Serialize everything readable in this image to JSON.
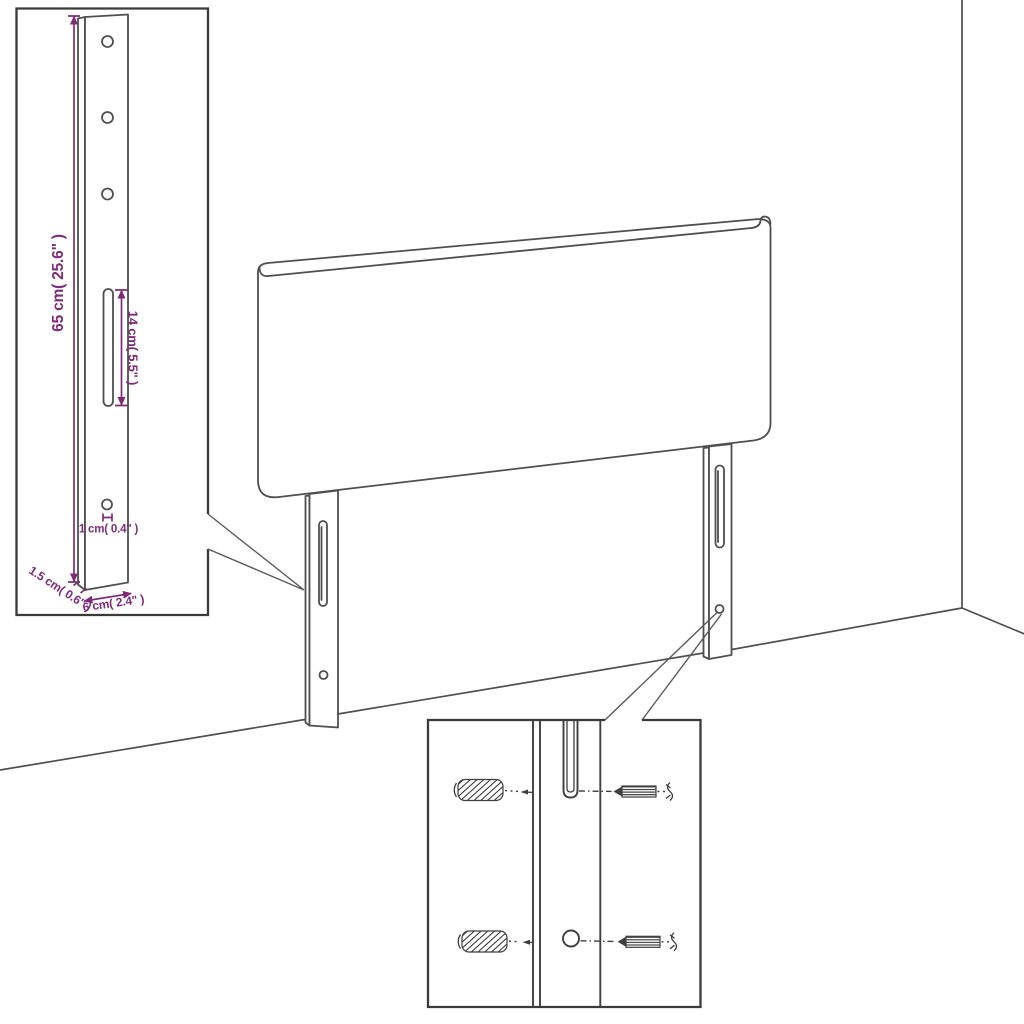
{
  "scene": {
    "background_color": "#ffffff",
    "line_color": "#4f4f4f",
    "box_border_color": "#3a3a3a",
    "accent_color": "#7e2a79",
    "product": "upholstered headboard with two slotted mounting legs",
    "environment": [
      "wall-corner",
      "floor-line"
    ]
  },
  "dimension_callout": {
    "description": "close-up of mounting leg with measurements",
    "labels": {
      "leg_height": "65 cm( 25.6\" )",
      "slot_length": "14 cm( 5.5\" )",
      "hole_offset": "1 cm( 0.4\" )",
      "leg_thickness": "1.5 cm( 0.6\" )",
      "leg_width": "6 cm( 2.4\" )"
    }
  },
  "hardware_callout": {
    "description": "close-up of leg slot and hole with wall plugs and screws",
    "icons": [
      "wall-plug-icon",
      "screw-icon"
    ],
    "rows": 2
  }
}
